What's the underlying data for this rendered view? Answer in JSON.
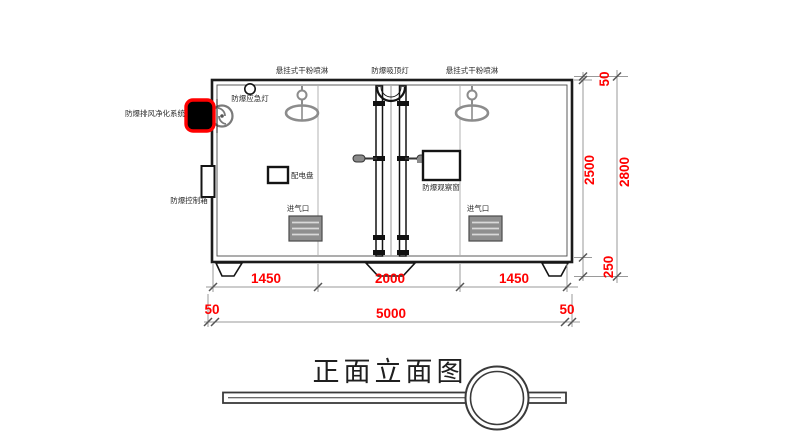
{
  "title": {
    "text": "正面立面图"
  },
  "equipment_labels": {
    "sprinkler_left": "悬挂式干粉喷淋",
    "ceiling_light": "防爆吸顶灯",
    "sprinkler_right": "悬挂式干粉喷淋",
    "emergency_light": "防爆应急灯",
    "exhaust_purifier": "防爆排风净化系统",
    "control_box": "防爆控制箱",
    "power_panel": "配电盘",
    "observation_window": "防爆观察窗",
    "air_inlet_left": "进气口",
    "air_inlet_right": "进气口"
  },
  "dimensions": {
    "bottom_segments": [
      "1450",
      "2000",
      "1450"
    ],
    "bottom_left_offset": "50",
    "bottom_total": "5000",
    "bottom_right_offset": "50",
    "right_top_offset": "50",
    "right_inner_height": "2500",
    "right_total_height": "2800",
    "right_base_height": "250"
  },
  "colors": {
    "dimension_text": "#ff0000",
    "highlight_border": "#ff0000",
    "line": "#1c1c1c",
    "dim_line": "#9a9a9a",
    "fixture_gray": "#8c8c8c"
  }
}
